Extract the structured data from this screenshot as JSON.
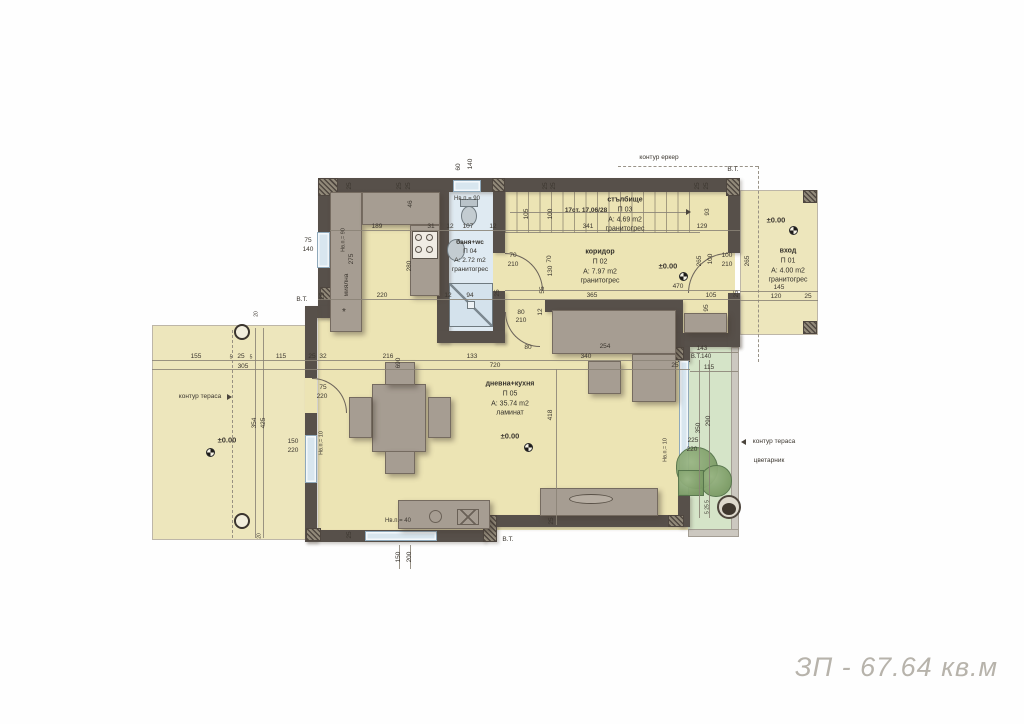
{
  "plan": {
    "total_area": "ЗП - 67.64 кв.м",
    "colors": {
      "wall": "#57504a",
      "floor": "#ece4b4",
      "bath_floor": "#dfeaf2",
      "terrace_green": "#d5e4c8",
      "window": "#d8e6ef",
      "furniture": "#a69d92",
      "title_text": "#b7b3ab"
    },
    "rooms": {
      "entry": {
        "name": "вход",
        "num": "П 01",
        "area": "A: 4.00 m2",
        "floor": "гранитогрес"
      },
      "corridor": {
        "name": "коридор",
        "num": "П 02",
        "area": "A: 7.97 m2",
        "floor": "гранитогрес"
      },
      "stairs": {
        "name": "стълбище",
        "num": "П 03",
        "area": "A: 4.69 m2",
        "floor": "гранитогрес"
      },
      "bath": {
        "name": "баня+wc",
        "num": "П 04",
        "area": "A: 2.72 m2",
        "floor": "гранитогрес"
      },
      "living": {
        "name": "дневна+кухня",
        "num": "П 05",
        "area": "A: 35.74 m2",
        "floor": "ламинат"
      }
    },
    "labels": [
      {
        "t": "контур еркер",
        "x": 659,
        "y": 158
      },
      {
        "t": "В.Т.",
        "x": 733,
        "y": 170
      },
      {
        "t": "60",
        "x": 459,
        "y": 167,
        "v": 1
      },
      {
        "t": "140",
        "x": 471,
        "y": 164,
        "v": 1
      },
      {
        "t": "25",
        "x": 350,
        "y": 186,
        "v": 1
      },
      {
        "t": "25",
        "x": 400,
        "y": 186,
        "v": 1
      },
      {
        "t": "25",
        "x": 409,
        "y": 186,
        "v": 1
      },
      {
        "t": "25",
        "x": 546,
        "y": 186,
        "v": 1
      },
      {
        "t": "25",
        "x": 554,
        "y": 186,
        "v": 1
      },
      {
        "t": "25",
        "x": 698,
        "y": 186,
        "v": 1
      },
      {
        "t": "25",
        "x": 707,
        "y": 186,
        "v": 1
      },
      {
        "t": "189",
        "x": 377,
        "y": 227
      },
      {
        "t": "31",
        "x": 431,
        "y": 227
      },
      {
        "t": "12",
        "x": 450,
        "y": 227
      },
      {
        "t": "107",
        "x": 468,
        "y": 227
      },
      {
        "t": "12",
        "x": 493,
        "y": 227
      },
      {
        "t": "46",
        "x": 411,
        "y": 204,
        "v": 1
      },
      {
        "t": "Нв.п.= 90",
        "x": 467,
        "y": 199,
        "s": 6
      },
      {
        "t": "75",
        "x": 308,
        "y": 241
      },
      {
        "t": "140",
        "x": 308,
        "y": 250
      },
      {
        "t": "Нв.п.= 90",
        "x": 344,
        "y": 240,
        "v": 1,
        "s": 5.5
      },
      {
        "t": "275",
        "x": 352,
        "y": 259,
        "v": 1
      },
      {
        "t": "миялна",
        "x": 347,
        "y": 285,
        "v": 1
      },
      {
        "t": "280",
        "x": 410,
        "y": 266,
        "v": 1
      },
      {
        "t": "220",
        "x": 382,
        "y": 296
      },
      {
        "t": "25",
        "x": 323,
        "y": 296,
        "v": 1
      },
      {
        "t": "В.Т.",
        "x": 302,
        "y": 300
      },
      {
        "t": "*",
        "x": 344,
        "y": 313,
        "s": 10
      },
      {
        "t": "12",
        "x": 448,
        "y": 296
      },
      {
        "t": "94",
        "x": 470,
        "y": 296
      },
      {
        "t": "25",
        "x": 498,
        "y": 293,
        "v": 1
      },
      {
        "t": "17ст. 17,06/28",
        "x": 586,
        "y": 211,
        "b": 1
      },
      {
        "t": "105",
        "x": 527,
        "y": 214,
        "v": 1
      },
      {
        "t": "100",
        "x": 551,
        "y": 214,
        "v": 1
      },
      {
        "t": "341",
        "x": 588,
        "y": 227
      },
      {
        "t": "129",
        "x": 702,
        "y": 227
      },
      {
        "t": "93",
        "x": 708,
        "y": 212,
        "v": 1
      },
      {
        "t": "70",
        "x": 513,
        "y": 256
      },
      {
        "t": "210",
        "x": 513,
        "y": 265
      },
      {
        "t": "70",
        "x": 550,
        "y": 259,
        "v": 1
      },
      {
        "t": "130",
        "x": 551,
        "y": 271,
        "v": 1
      },
      {
        "t": "55",
        "x": 543,
        "y": 290,
        "v": 1
      },
      {
        "t": "±0.00",
        "x": 668,
        "y": 266,
        "b": 1,
        "s": 7.5
      },
      {
        "t": "470",
        "x": 678,
        "y": 287
      },
      {
        "t": "365",
        "x": 592,
        "y": 296
      },
      {
        "t": "105",
        "x": 711,
        "y": 296
      },
      {
        "t": "25",
        "x": 737,
        "y": 294,
        "v": 1
      },
      {
        "t": "265",
        "x": 700,
        "y": 261,
        "v": 1
      },
      {
        "t": "100",
        "x": 711,
        "y": 259,
        "v": 1
      },
      {
        "t": "100",
        "x": 727,
        "y": 256
      },
      {
        "t": "210",
        "x": 727,
        "y": 265
      },
      {
        "t": "265",
        "x": 748,
        "y": 261,
        "v": 1
      },
      {
        "t": "95",
        "x": 707,
        "y": 308,
        "v": 1
      },
      {
        "t": "±0.00",
        "x": 776,
        "y": 220,
        "b": 1,
        "s": 7.5
      },
      {
        "t": "145",
        "x": 779,
        "y": 288
      },
      {
        "t": "120",
        "x": 776,
        "y": 297
      },
      {
        "t": "25",
        "x": 808,
        "y": 297
      },
      {
        "t": "80",
        "x": 521,
        "y": 313
      },
      {
        "t": "210",
        "x": 521,
        "y": 321
      },
      {
        "t": "12",
        "x": 541,
        "y": 312,
        "v": 1
      },
      {
        "t": "80",
        "x": 528,
        "y": 348
      },
      {
        "t": "254",
        "x": 605,
        "y": 347
      },
      {
        "t": "340",
        "x": 586,
        "y": 357
      },
      {
        "t": "133",
        "x": 472,
        "y": 357
      },
      {
        "t": "216",
        "x": 388,
        "y": 357
      },
      {
        "t": "690",
        "x": 399,
        "y": 363,
        "v": 1
      },
      {
        "t": "720",
        "x": 495,
        "y": 366
      },
      {
        "t": "418",
        "x": 551,
        "y": 415,
        "v": 1
      },
      {
        "t": "25",
        "x": 312,
        "y": 357
      },
      {
        "t": "32",
        "x": 323,
        "y": 357
      },
      {
        "t": "155",
        "x": 196,
        "y": 357
      },
      {
        "t": "5",
        "x": 231,
        "y": 358,
        "s": 5
      },
      {
        "t": "25",
        "x": 241,
        "y": 357
      },
      {
        "t": "5",
        "x": 251,
        "y": 358,
        "s": 5
      },
      {
        "t": "115",
        "x": 281,
        "y": 357
      },
      {
        "t": "305",
        "x": 243,
        "y": 367
      },
      {
        "t": "354",
        "x": 255,
        "y": 423,
        "v": 1
      },
      {
        "t": "425",
        "x": 264,
        "y": 423,
        "v": 1
      },
      {
        "t": "контур тераса",
        "x": 200,
        "y": 397
      },
      {
        "t": "±0.00",
        "x": 227,
        "y": 440,
        "b": 1,
        "s": 7.5
      },
      {
        "t": "20",
        "x": 257,
        "y": 314,
        "v": 1,
        "s": 5
      },
      {
        "t": "20",
        "x": 260,
        "y": 536,
        "v": 1,
        "s": 5
      },
      {
        "t": "75",
        "x": 323,
        "y": 388
      },
      {
        "t": "220",
        "x": 322,
        "y": 397
      },
      {
        "t": "150",
        "x": 293,
        "y": 442
      },
      {
        "t": "220",
        "x": 293,
        "y": 451
      },
      {
        "t": "Нв.п.= 10",
        "x": 322,
        "y": 443,
        "v": 1,
        "s": 5.5
      },
      {
        "t": "±0.00",
        "x": 510,
        "y": 436,
        "b": 1,
        "s": 7.5
      },
      {
        "t": "Нв.п.= 40",
        "x": 398,
        "y": 521,
        "s": 6
      },
      {
        "t": "150",
        "x": 399,
        "y": 557,
        "v": 1
      },
      {
        "t": "200",
        "x": 410,
        "y": 557,
        "v": 1
      },
      {
        "t": "25",
        "x": 350,
        "y": 535,
        "v": 1
      },
      {
        "t": "В.Т.",
        "x": 508,
        "y": 540
      },
      {
        "t": "25",
        "x": 552,
        "y": 521,
        "v": 1
      },
      {
        "t": "143",
        "x": 702,
        "y": 349
      },
      {
        "t": "В.Т.140",
        "x": 701,
        "y": 357,
        "s": 6
      },
      {
        "t": "25",
        "x": 675,
        "y": 366
      },
      {
        "t": "115",
        "x": 709,
        "y": 368
      },
      {
        "t": "350",
        "x": 699,
        "y": 428,
        "v": 1
      },
      {
        "t": "290",
        "x": 709,
        "y": 421,
        "v": 1
      },
      {
        "t": "225",
        "x": 693,
        "y": 441
      },
      {
        "t": "220",
        "x": 692,
        "y": 450
      },
      {
        "t": "Нв.п.= 10",
        "x": 666,
        "y": 450,
        "v": 1,
        "s": 5.5
      },
      {
        "t": "контур тераса",
        "x": 774,
        "y": 442
      },
      {
        "t": "цветарник",
        "x": 769,
        "y": 461
      },
      {
        "t": "5 25 5",
        "x": 708,
        "y": 507,
        "v": 1,
        "s": 5
      }
    ]
  }
}
